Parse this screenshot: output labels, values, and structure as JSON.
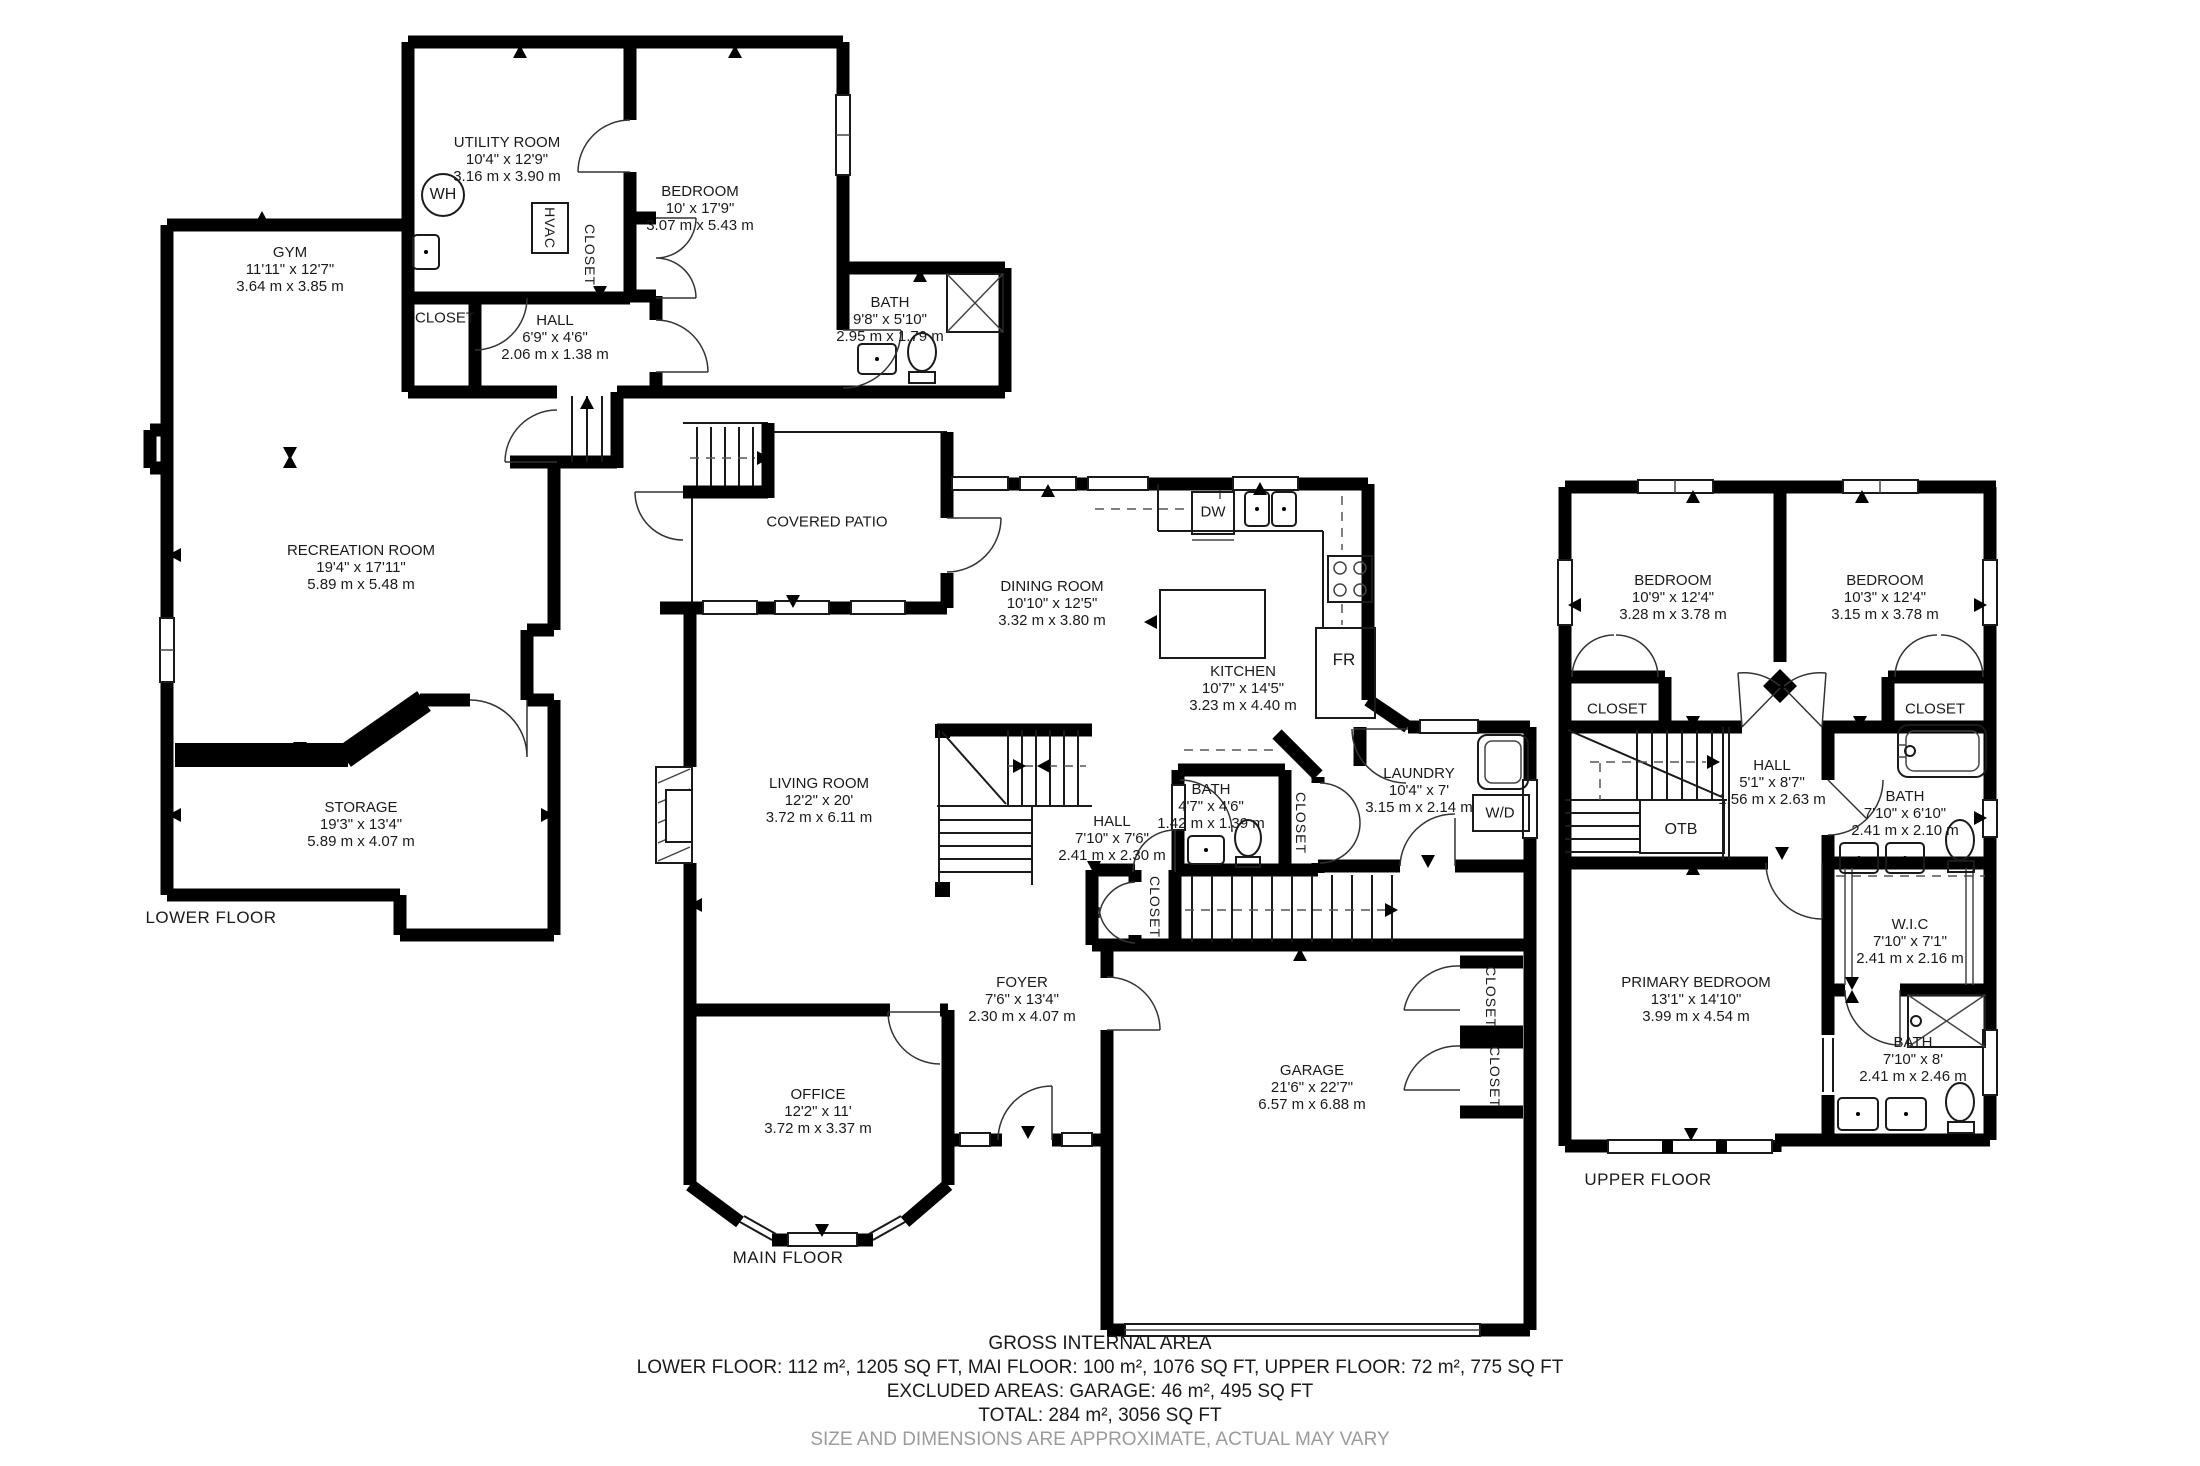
{
  "footer": {
    "title": "GROSS INTERNAL AREA",
    "areas": "LOWER FLOOR: 112 m², 1205 SQ FT, MAI FLOOR: 100 m², 1076 SQ FT, UPPER FLOOR: 72 m², 775 SQ FT",
    "excluded": "EXCLUDED AREAS: GARAGE: 46 m², 495 SQ FT",
    "total": "TOTAL: 284 m², 3056 SQ FT",
    "disclaimer": "SIZE AND DIMENSIONS ARE APPROXIMATE, ACTUAL MAY VARY"
  },
  "floors": {
    "lower": {
      "caption": "LOWER FLOOR",
      "rooms": {
        "utility": {
          "name": "UTILITY ROOM",
          "ft": "10'4\" x 12'9\"",
          "m": "3.16 m x 3.90 m"
        },
        "bedroom": {
          "name": "BEDROOM",
          "ft": "10' x 17'9\"",
          "m": "3.07 m x 5.43 m"
        },
        "gym": {
          "name": "GYM",
          "ft": "11'11\" x 12'7\"",
          "m": "3.64 m x 3.85 m"
        },
        "hall": {
          "name": "HALL",
          "ft": "6'9\" x 4'6\"",
          "m": "2.06 m x 1.38 m"
        },
        "bath": {
          "name": "BATH",
          "ft": "9'8\" x 5'10\"",
          "m": "2.95 m x 1.79 m"
        },
        "recreation": {
          "name": "RECREATION ROOM",
          "ft": "19'4\" x 17'11\"",
          "m": "5.89 m x 5.48 m"
        },
        "storage": {
          "name": "STORAGE",
          "ft": "19'3\" x 13'4\"",
          "m": "5.89 m x 4.07 m"
        }
      },
      "fixtures": {
        "wh": "WH",
        "hvac": "HVAC",
        "closet": "CLOSET"
      }
    },
    "main": {
      "caption": "MAIN FLOOR",
      "rooms": {
        "patio": {
          "name": "COVERED PATIO"
        },
        "dining": {
          "name": "DINING ROOM",
          "ft": "10'10\" x 12'5\"",
          "m": "3.32 m x 3.80 m"
        },
        "kitchen": {
          "name": "KITCHEN",
          "ft": "10'7\" x 14'5\"",
          "m": "3.23 m x 4.40 m"
        },
        "living": {
          "name": "LIVING ROOM",
          "ft": "12'2\" x 20'",
          "m": "3.72 m x 6.11 m"
        },
        "hall": {
          "name": "HALL",
          "ft": "7'10\" x 7'6\"",
          "m": "2.41 m x 2.30 m"
        },
        "bath": {
          "name": "BATH",
          "ft": "4'7\" x 4'6\"",
          "m": "1.42 m x 1.39 m"
        },
        "laundry": {
          "name": "LAUNDRY",
          "ft": "10'4\" x 7'",
          "m": "3.15 m x 2.14 m"
        },
        "foyer": {
          "name": "FOYER",
          "ft": "7'6\" x 13'4\"",
          "m": "2.30 m x 4.07 m"
        },
        "office": {
          "name": "OFFICE",
          "ft": "12'2\" x 11'",
          "m": "3.72 m x 3.37 m"
        },
        "garage": {
          "name": "GARAGE",
          "ft": "21'6\" x 22'7\"",
          "m": "6.57 m x 6.88 m"
        }
      },
      "fixtures": {
        "dw": "DW",
        "fr": "FR",
        "wd": "W/D",
        "closet": "CLOSET"
      }
    },
    "upper": {
      "caption": "UPPER FLOOR",
      "rooms": {
        "bedroom_left": {
          "name": "BEDROOM",
          "ft": "10'9\" x 12'4\"",
          "m": "3.28 m x 3.78 m"
        },
        "bedroom_right": {
          "name": "BEDROOM",
          "ft": "10'3\" x 12'4\"",
          "m": "3.15 m x 3.78 m"
        },
        "hall": {
          "name": "HALL",
          "ft": "5'1\" x 8'7\"",
          "m": "1.56 m x 2.63 m"
        },
        "bath_top": {
          "name": "BATH",
          "ft": "7'10\" x 6'10\"",
          "m": "2.41 m x 2.10 m"
        },
        "wic": {
          "name": "W.I.C",
          "ft": "7'10\" x 7'1\"",
          "m": "2.41 m x 2.16 m"
        },
        "primary": {
          "name": "PRIMARY BEDROOM",
          "ft": "13'1\" x 14'10\"",
          "m": "3.99 m x 4.54 m"
        },
        "bath_bottom": {
          "name": "BATH",
          "ft": "7'10\" x 8'",
          "m": "2.41 m x 2.46 m"
        }
      },
      "fixtures": {
        "otb": "OTB",
        "closet": "CLOSET"
      }
    }
  }
}
